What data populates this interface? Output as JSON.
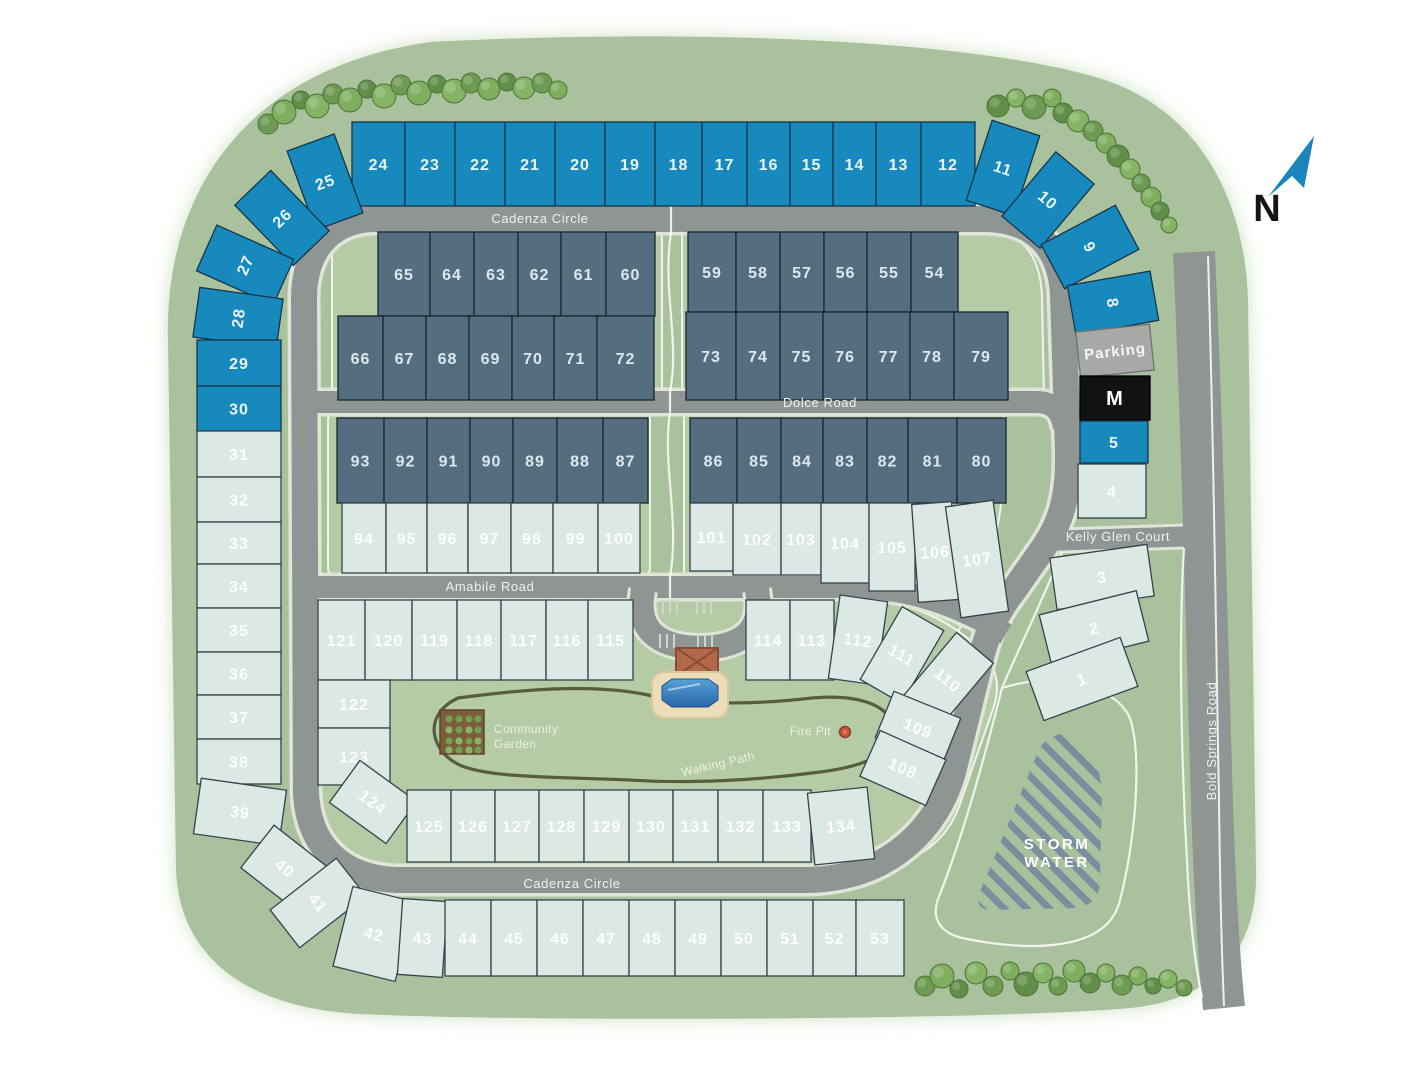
{
  "roads": {
    "cadenza_circle_top": "Cadenza Circle",
    "cadenza_circle_bottom": "Cadenza Circle",
    "dolce_road": "Dolce Road",
    "amabile_road": "Amabile Road",
    "kelly_glen_court": "Kelly Glen Court",
    "bold_springs_road": "Bold Springs Road"
  },
  "amenities": {
    "community_garden_line1": "Community",
    "community_garden_line2": "Garden",
    "fire_pit": "Fire Pit",
    "walking_path": "Walking Path",
    "storm_water_line1": "STORM",
    "storm_water_line2": "WATER"
  },
  "compass": {
    "label": "N"
  },
  "colors": {
    "map_green": "#a9c29d",
    "block_green": "#b4cba6",
    "road_gray": "#8f9592",
    "sidewalk": "#dfe6d8",
    "storm_stripe": "#74889f",
    "walking_path": "#4f5433",
    "pool_water": "#2e73b4",
    "pool_deck": "#ecdcba",
    "clubhouse": "#b4684a",
    "garden_soil": "#7d5c3c",
    "compass_blue": "#1a85ba",
    "lot_groups": {
      "blue": {
        "fill": "#1789bd",
        "stroke": "#15354a",
        "text": "#eaf6fb"
      },
      "dark": {
        "fill": "#546e80",
        "stroke": "#1a2630",
        "text": "#dde8ee"
      },
      "light": {
        "fill": "#dbe8e3",
        "stroke": "#31444c",
        "text": "rgba(255,255,255,0.92)"
      },
      "parking": {
        "fill": "#a7a9a6",
        "stroke": "#6e7270",
        "text": "#f5f7f4"
      },
      "mail": {
        "fill": "#121212",
        "stroke": "#000000",
        "text": "#ffffff"
      }
    }
  },
  "lots": [
    {
      "n": "24",
      "g": "blue",
      "x": 352,
      "y": 122,
      "w": 53,
      "h": 84
    },
    {
      "n": "23",
      "g": "blue",
      "x": 405,
      "y": 122,
      "w": 50,
      "h": 84
    },
    {
      "n": "22",
      "g": "blue",
      "x": 455,
      "y": 122,
      "w": 50,
      "h": 84
    },
    {
      "n": "21",
      "g": "blue",
      "x": 505,
      "y": 122,
      "w": 50,
      "h": 84
    },
    {
      "n": "20",
      "g": "blue",
      "x": 555,
      "y": 122,
      "w": 50,
      "h": 84
    },
    {
      "n": "19",
      "g": "blue",
      "x": 605,
      "y": 122,
      "w": 50,
      "h": 84
    },
    {
      "n": "18",
      "g": "blue",
      "x": 655,
      "y": 122,
      "w": 47,
      "h": 84
    },
    {
      "n": "17",
      "g": "blue",
      "x": 702,
      "y": 122,
      "w": 45,
      "h": 84
    },
    {
      "n": "16",
      "g": "blue",
      "x": 747,
      "y": 122,
      "w": 43,
      "h": 84
    },
    {
      "n": "15",
      "g": "blue",
      "x": 790,
      "y": 122,
      "w": 43,
      "h": 84
    },
    {
      "n": "14",
      "g": "blue",
      "x": 833,
      "y": 122,
      "w": 43,
      "h": 84
    },
    {
      "n": "13",
      "g": "blue",
      "x": 876,
      "y": 122,
      "w": 45,
      "h": 84
    },
    {
      "n": "12",
      "g": "blue",
      "x": 921,
      "y": 122,
      "w": 54,
      "h": 84
    },
    {
      "n": "25",
      "g": "blue",
      "x": 300,
      "y": 140,
      "w": 50,
      "h": 84,
      "r": -20
    },
    {
      "n": "26",
      "g": "blue",
      "x": 257,
      "y": 176,
      "w": 50,
      "h": 84,
      "r": -44
    },
    {
      "n": "27",
      "g": "blue",
      "x": 220,
      "y": 223,
      "w": 50,
      "h": 84,
      "r": -66
    },
    {
      "n": "28",
      "g": "blue",
      "x": 213,
      "y": 276,
      "w": 50,
      "h": 84,
      "r": -82
    },
    {
      "n": "29",
      "g": "blue",
      "x": 197,
      "y": 340,
      "w": 84,
      "h": 46
    },
    {
      "n": "30",
      "g": "blue",
      "x": 197,
      "y": 386,
      "w": 84,
      "h": 45
    },
    {
      "n": "31",
      "g": "light",
      "x": 197,
      "y": 431,
      "w": 84,
      "h": 46
    },
    {
      "n": "32",
      "g": "light",
      "x": 197,
      "y": 477,
      "w": 84,
      "h": 45
    },
    {
      "n": "33",
      "g": "light",
      "x": 197,
      "y": 522,
      "w": 84,
      "h": 42
    },
    {
      "n": "34",
      "g": "light",
      "x": 197,
      "y": 564,
      "w": 84,
      "h": 44
    },
    {
      "n": "35",
      "g": "light",
      "x": 197,
      "y": 608,
      "w": 84,
      "h": 44
    },
    {
      "n": "36",
      "g": "light",
      "x": 197,
      "y": 652,
      "w": 84,
      "h": 43
    },
    {
      "n": "37",
      "g": "light",
      "x": 197,
      "y": 695,
      "w": 84,
      "h": 44
    },
    {
      "n": "38",
      "g": "light",
      "x": 197,
      "y": 739,
      "w": 84,
      "h": 45
    },
    {
      "n": "39",
      "g": "light",
      "x": 197,
      "y": 784,
      "w": 86,
      "h": 56,
      "r": 8
    },
    {
      "n": "40",
      "g": "light",
      "x": 250,
      "y": 841,
      "w": 70,
      "h": 54,
      "r": 38
    },
    {
      "n": "41",
      "g": "light",
      "x": 294,
      "y": 861,
      "w": 48,
      "h": 84,
      "r": 52
    },
    {
      "n": "11",
      "g": "blue",
      "x": 978,
      "y": 126,
      "w": 50,
      "h": 84,
      "r": 18
    },
    {
      "n": "10",
      "g": "blue",
      "x": 1023,
      "y": 158,
      "w": 50,
      "h": 84,
      "r": 40
    },
    {
      "n": "9",
      "g": "blue",
      "x": 1065,
      "y": 205,
      "w": 50,
      "h": 84,
      "r": 62
    },
    {
      "n": "8",
      "g": "blue",
      "x": 1088,
      "y": 261,
      "w": 50,
      "h": 84,
      "r": 80
    },
    {
      "n": "Parking",
      "g": "parking",
      "x": 1078,
      "y": 328,
      "w": 74,
      "h": 46,
      "r": -6,
      "fs": 15
    },
    {
      "n": "M",
      "g": "mail",
      "x": 1080,
      "y": 376,
      "w": 70,
      "h": 44,
      "fs": 20
    },
    {
      "n": "5",
      "g": "blue",
      "x": 1080,
      "y": 421,
      "w": 68,
      "h": 42
    },
    {
      "n": "4",
      "g": "light",
      "x": 1078,
      "y": 464,
      "w": 68,
      "h": 54
    },
    {
      "n": "3",
      "g": "light",
      "x": 1053,
      "y": 551,
      "w": 98,
      "h": 52,
      "r": -8
    },
    {
      "n": "2",
      "g": "light",
      "x": 1044,
      "y": 602,
      "w": 100,
      "h": 52,
      "r": -14
    },
    {
      "n": "1",
      "g": "light",
      "x": 1032,
      "y": 653,
      "w": 100,
      "h": 52,
      "r": -20
    },
    {
      "n": "42",
      "g": "light",
      "x": 342,
      "y": 893,
      "w": 64,
      "h": 82,
      "r": 14
    },
    {
      "n": "43",
      "g": "light",
      "x": 400,
      "y": 900,
      "w": 45,
      "h": 76,
      "r": 4
    },
    {
      "n": "44",
      "g": "light",
      "x": 445,
      "y": 900,
      "w": 46,
      "h": 76
    },
    {
      "n": "45",
      "g": "light",
      "x": 491,
      "y": 900,
      "w": 46,
      "h": 76
    },
    {
      "n": "46",
      "g": "light",
      "x": 537,
      "y": 900,
      "w": 46,
      "h": 76
    },
    {
      "n": "47",
      "g": "light",
      "x": 583,
      "y": 900,
      "w": 46,
      "h": 76
    },
    {
      "n": "48",
      "g": "light",
      "x": 629,
      "y": 900,
      "w": 46,
      "h": 76
    },
    {
      "n": "49",
      "g": "light",
      "x": 675,
      "y": 900,
      "w": 46,
      "h": 76
    },
    {
      "n": "50",
      "g": "light",
      "x": 721,
      "y": 900,
      "w": 46,
      "h": 76
    },
    {
      "n": "51",
      "g": "light",
      "x": 767,
      "y": 900,
      "w": 46,
      "h": 76
    },
    {
      "n": "52",
      "g": "light",
      "x": 813,
      "y": 900,
      "w": 43,
      "h": 76
    },
    {
      "n": "53",
      "g": "light",
      "x": 856,
      "y": 900,
      "w": 48,
      "h": 76
    },
    {
      "n": "65",
      "g": "dark",
      "x": 378,
      "y": 232,
      "w": 52,
      "h": 84
    },
    {
      "n": "64",
      "g": "dark",
      "x": 430,
      "y": 232,
      "w": 44,
      "h": 84
    },
    {
      "n": "63",
      "g": "dark",
      "x": 474,
      "y": 232,
      "w": 44,
      "h": 84
    },
    {
      "n": "62",
      "g": "dark",
      "x": 518,
      "y": 232,
      "w": 43,
      "h": 84
    },
    {
      "n": "61",
      "g": "dark",
      "x": 561,
      "y": 232,
      "w": 45,
      "h": 84
    },
    {
      "n": "60",
      "g": "dark",
      "x": 606,
      "y": 232,
      "w": 49,
      "h": 84
    },
    {
      "n": "66",
      "g": "dark",
      "x": 338,
      "y": 316,
      "w": 45,
      "h": 84
    },
    {
      "n": "67",
      "g": "dark",
      "x": 383,
      "y": 316,
      "w": 43,
      "h": 84
    },
    {
      "n": "68",
      "g": "dark",
      "x": 426,
      "y": 316,
      "w": 43,
      "h": 84
    },
    {
      "n": "69",
      "g": "dark",
      "x": 469,
      "y": 316,
      "w": 43,
      "h": 84
    },
    {
      "n": "70",
      "g": "dark",
      "x": 512,
      "y": 316,
      "w": 42,
      "h": 84
    },
    {
      "n": "71",
      "g": "dark",
      "x": 554,
      "y": 316,
      "w": 43,
      "h": 84
    },
    {
      "n": "72",
      "g": "dark",
      "x": 597,
      "y": 316,
      "w": 57,
      "h": 84
    },
    {
      "n": "59",
      "g": "dark",
      "x": 688,
      "y": 232,
      "w": 48,
      "h": 80
    },
    {
      "n": "58",
      "g": "dark",
      "x": 736,
      "y": 232,
      "w": 44,
      "h": 80
    },
    {
      "n": "57",
      "g": "dark",
      "x": 780,
      "y": 232,
      "w": 44,
      "h": 80
    },
    {
      "n": "56",
      "g": "dark",
      "x": 824,
      "y": 232,
      "w": 43,
      "h": 80
    },
    {
      "n": "55",
      "g": "dark",
      "x": 867,
      "y": 232,
      "w": 44,
      "h": 80
    },
    {
      "n": "54",
      "g": "dark",
      "x": 911,
      "y": 232,
      "w": 47,
      "h": 80
    },
    {
      "n": "73",
      "g": "dark",
      "x": 686,
      "y": 312,
      "w": 50,
      "h": 88
    },
    {
      "n": "74",
      "g": "dark",
      "x": 736,
      "y": 312,
      "w": 44,
      "h": 88
    },
    {
      "n": "75",
      "g": "dark",
      "x": 780,
      "y": 312,
      "w": 43,
      "h": 88
    },
    {
      "n": "76",
      "g": "dark",
      "x": 823,
      "y": 312,
      "w": 44,
      "h": 88
    },
    {
      "n": "77",
      "g": "dark",
      "x": 867,
      "y": 312,
      "w": 43,
      "h": 88
    },
    {
      "n": "78",
      "g": "dark",
      "x": 910,
      "y": 312,
      "w": 44,
      "h": 88
    },
    {
      "n": "79",
      "g": "dark",
      "x": 954,
      "y": 312,
      "w": 54,
      "h": 88
    },
    {
      "n": "93",
      "g": "dark",
      "x": 337,
      "y": 418,
      "w": 47,
      "h": 85
    },
    {
      "n": "92",
      "g": "dark",
      "x": 384,
      "y": 418,
      "w": 43,
      "h": 85
    },
    {
      "n": "91",
      "g": "dark",
      "x": 427,
      "y": 418,
      "w": 43,
      "h": 85
    },
    {
      "n": "90",
      "g": "dark",
      "x": 470,
      "y": 418,
      "w": 43,
      "h": 85
    },
    {
      "n": "89",
      "g": "dark",
      "x": 513,
      "y": 418,
      "w": 44,
      "h": 85
    },
    {
      "n": "88",
      "g": "dark",
      "x": 557,
      "y": 418,
      "w": 46,
      "h": 85
    },
    {
      "n": "87",
      "g": "dark",
      "x": 603,
      "y": 418,
      "w": 45,
      "h": 85
    },
    {
      "n": "94",
      "g": "light",
      "x": 342,
      "y": 503,
      "w": 44,
      "h": 70
    },
    {
      "n": "95",
      "g": "light",
      "x": 386,
      "y": 503,
      "w": 41,
      "h": 70
    },
    {
      "n": "96",
      "g": "light",
      "x": 427,
      "y": 503,
      "w": 41,
      "h": 70
    },
    {
      "n": "97",
      "g": "light",
      "x": 468,
      "y": 503,
      "w": 43,
      "h": 70
    },
    {
      "n": "98",
      "g": "light",
      "x": 511,
      "y": 503,
      "w": 42,
      "h": 70
    },
    {
      "n": "99",
      "g": "light",
      "x": 553,
      "y": 503,
      "w": 45,
      "h": 70
    },
    {
      "n": "100",
      "g": "light",
      "x": 598,
      "y": 503,
      "w": 42,
      "h": 70
    },
    {
      "n": "86",
      "g": "dark",
      "x": 690,
      "y": 418,
      "w": 47,
      "h": 85
    },
    {
      "n": "85",
      "g": "dark",
      "x": 737,
      "y": 418,
      "w": 44,
      "h": 85
    },
    {
      "n": "84",
      "g": "dark",
      "x": 781,
      "y": 418,
      "w": 42,
      "h": 85
    },
    {
      "n": "83",
      "g": "dark",
      "x": 823,
      "y": 418,
      "w": 44,
      "h": 85
    },
    {
      "n": "82",
      "g": "dark",
      "x": 867,
      "y": 418,
      "w": 41,
      "h": 85
    },
    {
      "n": "81",
      "g": "dark",
      "x": 908,
      "y": 418,
      "w": 49,
      "h": 85
    },
    {
      "n": "80",
      "g": "dark",
      "x": 957,
      "y": 418,
      "w": 49,
      "h": 85
    },
    {
      "n": "101",
      "g": "light",
      "x": 690,
      "y": 503,
      "w": 43,
      "h": 68
    },
    {
      "n": "102",
      "g": "light",
      "x": 733,
      "y": 503,
      "w": 48,
      "h": 72
    },
    {
      "n": "103",
      "g": "light",
      "x": 781,
      "y": 503,
      "w": 40,
      "h": 72
    },
    {
      "n": "104",
      "g": "light",
      "x": 821,
      "y": 503,
      "w": 48,
      "h": 80
    },
    {
      "n": "105",
      "g": "light",
      "x": 869,
      "y": 503,
      "w": 46,
      "h": 88
    },
    {
      "n": "106",
      "g": "light",
      "x": 915,
      "y": 503,
      "w": 40,
      "h": 98,
      "r": -4
    },
    {
      "n": "107",
      "g": "light",
      "x": 953,
      "y": 503,
      "w": 48,
      "h": 112,
      "r": -8
    },
    {
      "n": "121",
      "g": "light",
      "x": 318,
      "y": 600,
      "w": 47,
      "h": 80
    },
    {
      "n": "120",
      "g": "light",
      "x": 365,
      "y": 600,
      "w": 47,
      "h": 80
    },
    {
      "n": "119",
      "g": "light",
      "x": 412,
      "y": 600,
      "w": 45,
      "h": 80
    },
    {
      "n": "118",
      "g": "light",
      "x": 457,
      "y": 600,
      "w": 44,
      "h": 80
    },
    {
      "n": "117",
      "g": "light",
      "x": 501,
      "y": 600,
      "w": 45,
      "h": 80
    },
    {
      "n": "116",
      "g": "light",
      "x": 546,
      "y": 600,
      "w": 42,
      "h": 80
    },
    {
      "n": "115",
      "g": "light",
      "x": 588,
      "y": 600,
      "w": 45,
      "h": 80
    },
    {
      "n": "114",
      "g": "light",
      "x": 746,
      "y": 600,
      "w": 44,
      "h": 80
    },
    {
      "n": "113",
      "g": "light",
      "x": 790,
      "y": 600,
      "w": 44,
      "h": 80
    },
    {
      "n": "112",
      "g": "light",
      "x": 834,
      "y": 598,
      "w": 48,
      "h": 84,
      "r": 8
    },
    {
      "n": "111",
      "g": "light",
      "x": 878,
      "y": 613,
      "w": 48,
      "h": 84,
      "r": 30
    },
    {
      "n": "110",
      "g": "light",
      "x": 924,
      "y": 638,
      "w": 48,
      "h": 84,
      "r": 40
    },
    {
      "n": "109",
      "g": "light",
      "x": 882,
      "y": 703,
      "w": 72,
      "h": 50,
      "r": 22
    },
    {
      "n": "108",
      "g": "light",
      "x": 867,
      "y": 743,
      "w": 72,
      "h": 50,
      "r": 24
    },
    {
      "n": "122",
      "g": "light",
      "x": 318,
      "y": 680,
      "w": 72,
      "h": 48
    },
    {
      "n": "123",
      "g": "light",
      "x": 318,
      "y": 728,
      "w": 72,
      "h": 57
    },
    {
      "n": "124",
      "g": "light",
      "x": 338,
      "y": 776,
      "w": 70,
      "h": 52,
      "r": 36
    },
    {
      "n": "125",
      "g": "light",
      "x": 407,
      "y": 790,
      "w": 44,
      "h": 72
    },
    {
      "n": "126",
      "g": "light",
      "x": 451,
      "y": 790,
      "w": 44,
      "h": 72
    },
    {
      "n": "127",
      "g": "light",
      "x": 495,
      "y": 790,
      "w": 44,
      "h": 72
    },
    {
      "n": "128",
      "g": "light",
      "x": 539,
      "y": 790,
      "w": 45,
      "h": 72
    },
    {
      "n": "129",
      "g": "light",
      "x": 584,
      "y": 790,
      "w": 45,
      "h": 72
    },
    {
      "n": "130",
      "g": "light",
      "x": 629,
      "y": 790,
      "w": 44,
      "h": 72
    },
    {
      "n": "131",
      "g": "light",
      "x": 673,
      "y": 790,
      "w": 45,
      "h": 72
    },
    {
      "n": "132",
      "g": "light",
      "x": 718,
      "y": 790,
      "w": 45,
      "h": 72
    },
    {
      "n": "133",
      "g": "light",
      "x": 763,
      "y": 790,
      "w": 48,
      "h": 72
    },
    {
      "n": "134",
      "g": "light",
      "x": 811,
      "y": 790,
      "w": 60,
      "h": 72,
      "r": -6
    }
  ],
  "trees": [
    [
      268,
      124,
      10
    ],
    [
      284,
      112,
      12
    ],
    [
      301,
      100,
      9
    ],
    [
      317,
      106,
      12
    ],
    [
      333,
      94,
      10
    ],
    [
      350,
      100,
      12
    ],
    [
      367,
      89,
      9
    ],
    [
      384,
      96,
      12
    ],
    [
      401,
      85,
      10
    ],
    [
      419,
      93,
      12
    ],
    [
      437,
      84,
      9
    ],
    [
      454,
      91,
      12
    ],
    [
      471,
      83,
      10
    ],
    [
      489,
      89,
      11
    ],
    [
      507,
      82,
      9
    ],
    [
      524,
      88,
      11
    ],
    [
      542,
      83,
      10
    ],
    [
      558,
      90,
      9
    ],
    [
      998,
      106,
      11
    ],
    [
      1016,
      98,
      9
    ],
    [
      1034,
      107,
      12
    ],
    [
      1052,
      98,
      9
    ],
    [
      1063,
      113,
      10
    ],
    [
      1078,
      121,
      11
    ],
    [
      1093,
      131,
      10
    ],
    [
      1106,
      143,
      10
    ],
    [
      1118,
      156,
      11
    ],
    [
      1130,
      169,
      10
    ],
    [
      1141,
      183,
      9
    ],
    [
      1151,
      197,
      10
    ],
    [
      1160,
      211,
      9
    ],
    [
      1169,
      225,
      8
    ],
    [
      925,
      986,
      10
    ],
    [
      942,
      976,
      12
    ],
    [
      959,
      989,
      9
    ],
    [
      976,
      973,
      11
    ],
    [
      993,
      986,
      10
    ],
    [
      1010,
      971,
      9
    ],
    [
      1026,
      984,
      12
    ],
    [
      1043,
      973,
      10
    ],
    [
      1058,
      986,
      9
    ],
    [
      1074,
      971,
      11
    ],
    [
      1090,
      983,
      10
    ],
    [
      1106,
      973,
      9
    ],
    [
      1122,
      985,
      10
    ],
    [
      1138,
      976,
      9
    ],
    [
      1153,
      986,
      8
    ],
    [
      1168,
      979,
      9
    ],
    [
      1184,
      988,
      8
    ]
  ]
}
